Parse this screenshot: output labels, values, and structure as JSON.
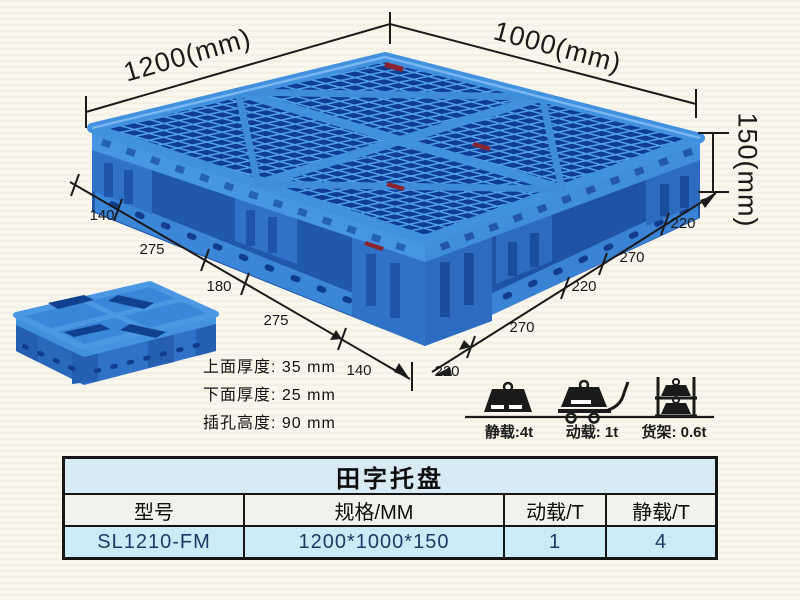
{
  "dimensions": {
    "top_left": "1200(mm)",
    "top_right": "1000(mm)",
    "height": "150(mm)",
    "left_chain": [
      "140",
      "275",
      "180",
      "275",
      "140"
    ],
    "right_chain": [
      "220",
      "270",
      "220",
      "270",
      "220"
    ]
  },
  "specs": {
    "line1": "上面厚度: 35 mm",
    "line2": "下面厚度: 25 mm",
    "line3": "插孔高度: 90 mm"
  },
  "load_ratings": {
    "static": "静载:4t",
    "dynamic": "动载: 1t",
    "rack": "货架: 0.6t"
  },
  "table": {
    "title": "田字托盘",
    "headers": [
      "型号",
      "规格/MM",
      "动载/T",
      "静载/T"
    ],
    "row": [
      "SL1210-FM",
      "1200*1000*150",
      "1",
      "4"
    ]
  },
  "colors": {
    "pallet_blue": "#3b82d8",
    "pallet_dark_blue": "#0e3c96",
    "dimension_line": "#1a1a1a",
    "table_title_bg": "#d8eaf4",
    "table_row_bg": "#cdeaf7",
    "background": "#f9f6ee"
  }
}
